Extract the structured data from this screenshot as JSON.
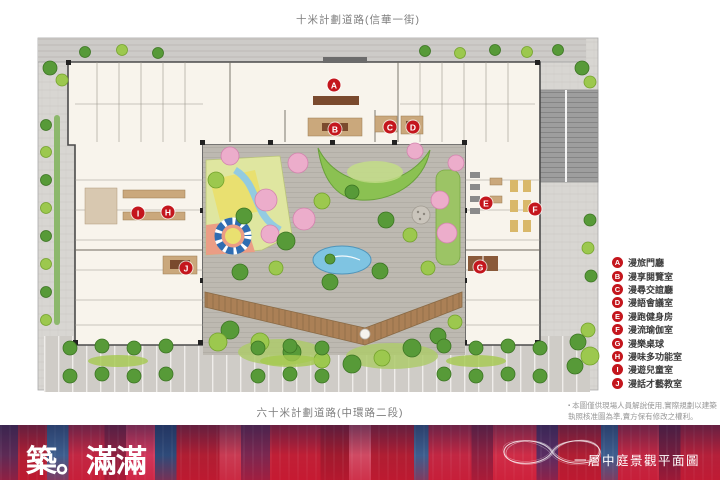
{
  "roads": {
    "top_label": "十米計劃道路(信華一街)",
    "bottom_label": "六十米計劃道路(中環路二段)"
  },
  "legend": {
    "badge_color": "#c4161d",
    "items": [
      {
        "letter": "A",
        "label": "漫旅門廳"
      },
      {
        "letter": "B",
        "label": "漫享閱覽室"
      },
      {
        "letter": "C",
        "label": "漫尋交誼廳"
      },
      {
        "letter": "D",
        "label": "漫語會議室"
      },
      {
        "letter": "E",
        "label": "漫跑健身房"
      },
      {
        "letter": "F",
        "label": "漫流瑜伽室"
      },
      {
        "letter": "G",
        "label": "漫樂桌球"
      },
      {
        "letter": "H",
        "label": "漫味多功能室"
      },
      {
        "letter": "I",
        "label": "漫遊兒童室"
      },
      {
        "letter": "J",
        "label": "漫話才藝教室"
      }
    ]
  },
  "footnote": {
    "bullet": "▪",
    "line1": "本圖僅供現場人員解說使用,實際規劃以建築",
    "line2": "執照核准圖為準,賣方保有修改之權利。"
  },
  "footer": {
    "logo_text": "築。滿滿",
    "title": "一層中庭景觀平面圖",
    "banner_main_color": "#b01e33",
    "banner_blue_color": "#3d5e8e"
  }
}
